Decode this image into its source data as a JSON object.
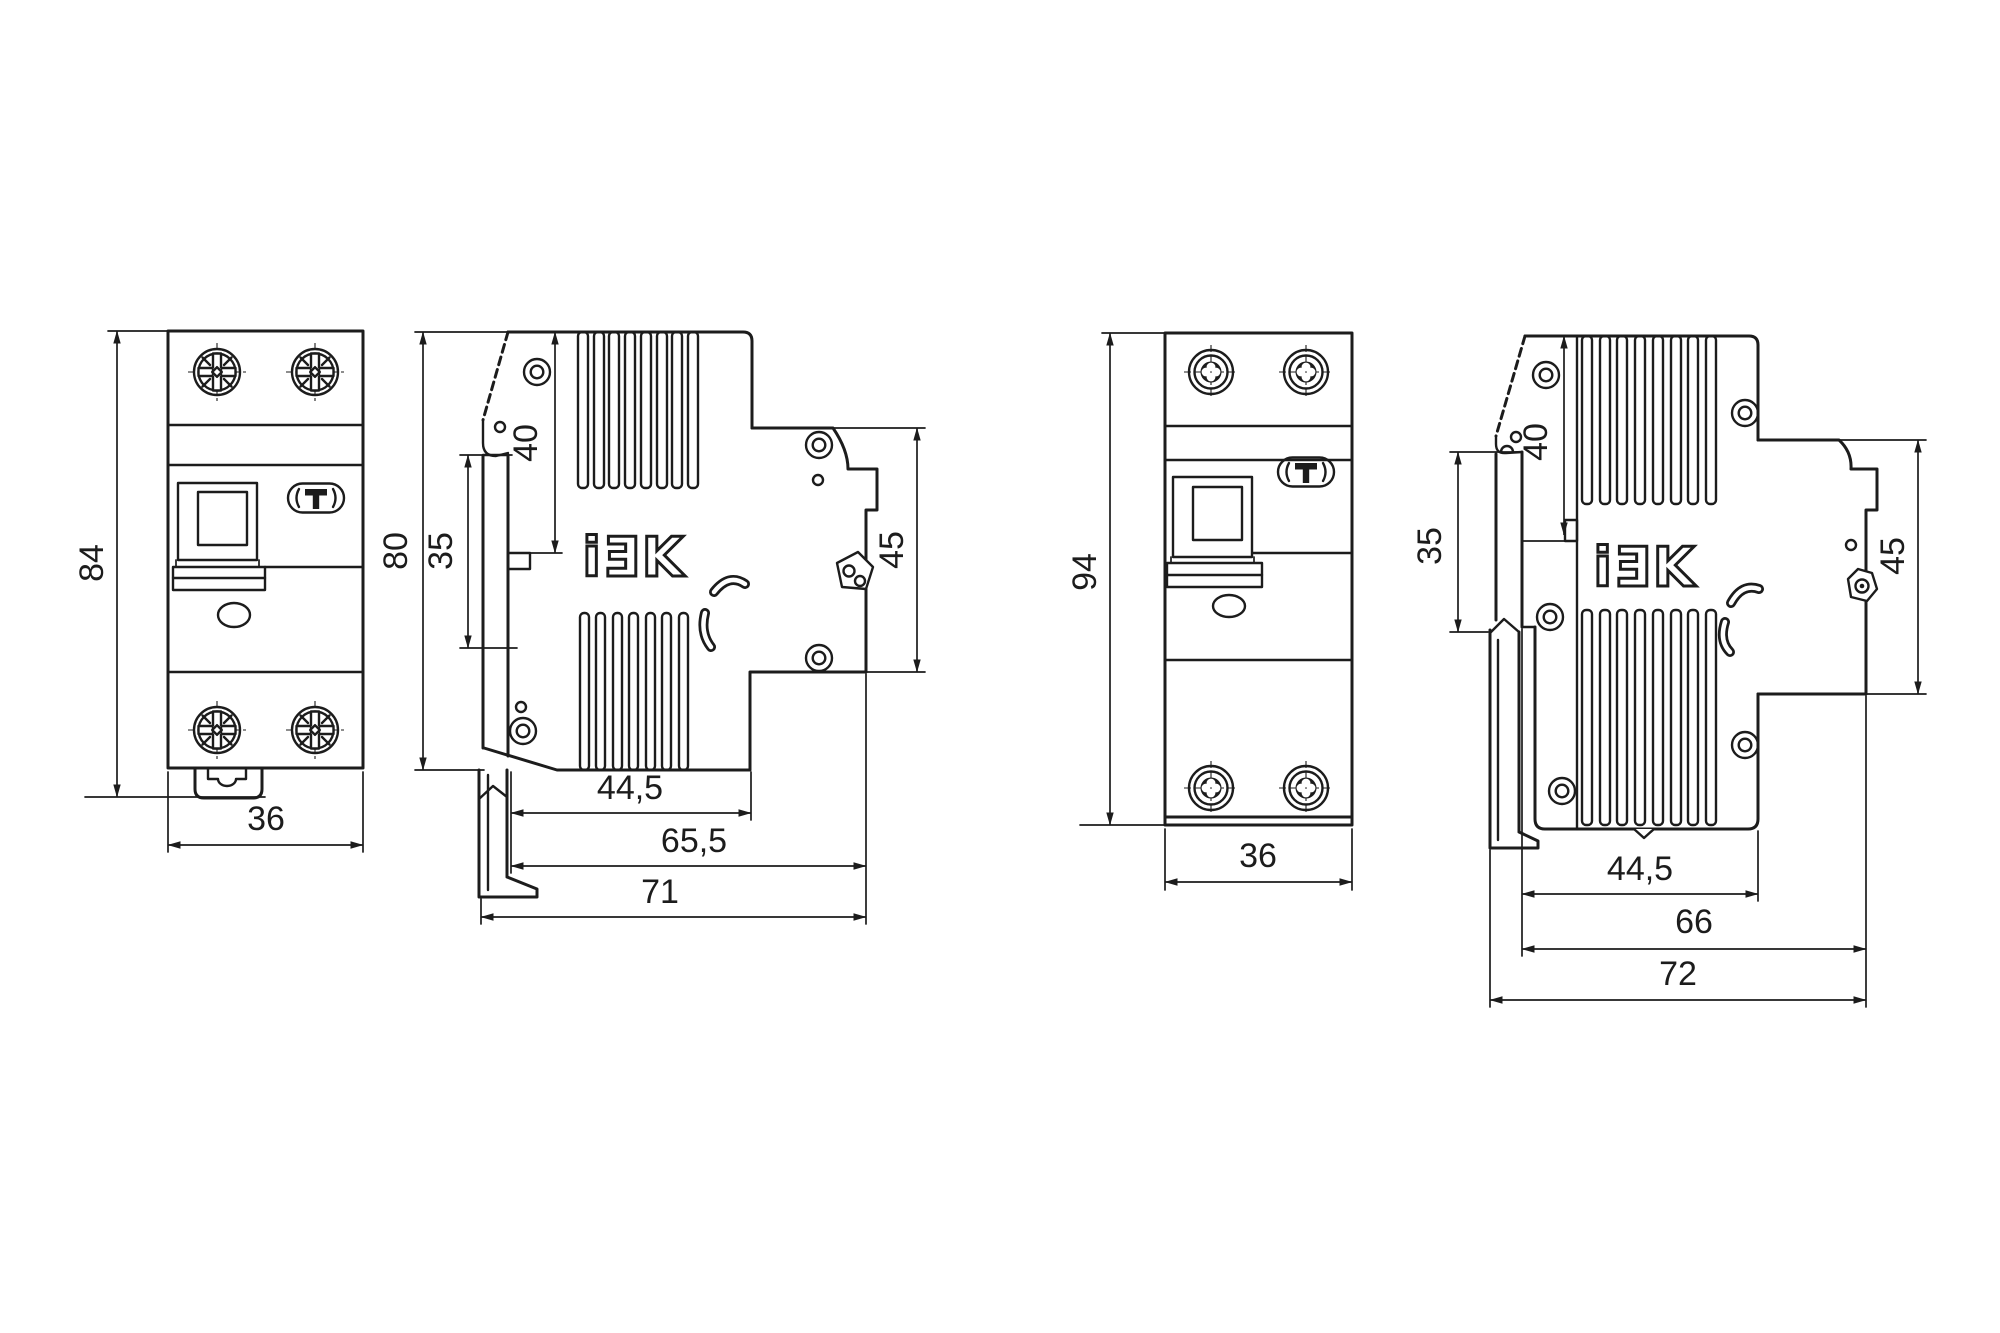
{
  "drawing": {
    "background": "#ffffff",
    "line_color": "#1c1c1c",
    "logo_text": "iƎK",
    "views": {
      "front_small": {
        "title": "front view (84 mm device)",
        "height": "84",
        "width": "36"
      },
      "side_small": {
        "title": "side view (84 mm device)",
        "overall_height": "80",
        "din_plate_height": "35",
        "upper_depth": "40",
        "terminal_span": "45",
        "body_depth": "44,5",
        "depth_to_terminals": "65,5",
        "overall_depth": "71"
      },
      "front_large": {
        "title": "front view (94 mm device)",
        "height": "94",
        "width": "36"
      },
      "side_large": {
        "title": "side view (94 mm device)",
        "din_plate_height": "35",
        "upper_depth": "40",
        "terminal_span": "45",
        "body_depth": "44,5",
        "depth_to_terminals": "66",
        "overall_depth": "72"
      }
    }
  }
}
